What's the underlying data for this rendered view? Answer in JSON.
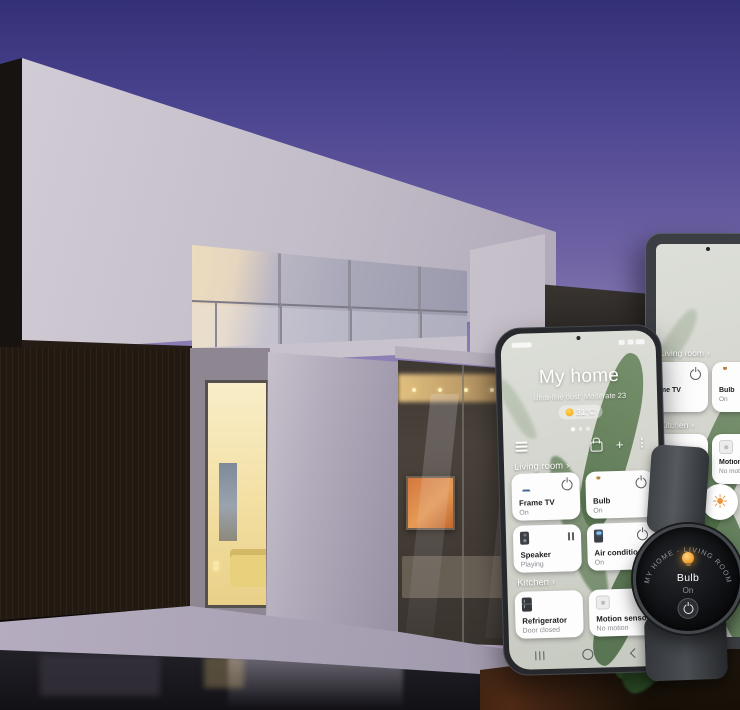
{
  "phone": {
    "app_title": "My home",
    "air_quality": "Ultra-fine dust: Moderate 23",
    "temperature": "31°C",
    "toolbar": {
      "add_glyph": "+",
      "more_glyph": "⋮"
    },
    "sections": [
      {
        "label": "Living room",
        "chevron": "›",
        "cards": [
          {
            "name": "Frame TV",
            "status": "On"
          },
          {
            "name": "Bulb",
            "status": "On"
          },
          {
            "name": "Speaker",
            "status": "Playing"
          },
          {
            "name": "Air conditioner",
            "status": "On"
          }
        ]
      },
      {
        "label": "Kitchen",
        "chevron": "›",
        "cards": [
          {
            "name": "Refrigerator",
            "status": "Door closed"
          },
          {
            "name": "Motion sensor",
            "status": "No motion"
          }
        ]
      }
    ]
  },
  "tablet": {
    "sections": [
      {
        "label": "Living room",
        "chevron": "›",
        "cards": [
          {
            "name": "Frame TV",
            "status": "On"
          },
          {
            "name": "Bulb",
            "status": "On"
          }
        ]
      },
      {
        "label": "Kitchen",
        "chevron": "›",
        "cards": [
          {
            "name": "Refrigerator",
            "status": "Door closed"
          },
          {
            "name": "Motion sensor",
            "status": "No motion"
          }
        ]
      }
    ],
    "sun_glyph": "☀"
  },
  "watch": {
    "context_arc": "MY HOME - LIVING ROOM",
    "device_name": "Bulb",
    "device_status": "On"
  },
  "colors": {
    "bulb_orange": "#f09a22",
    "tv_blue": "#79b0e4",
    "card_bg": "#fdfdfe",
    "sky_top": "#343077",
    "sky_bottom": "#c8b5cf"
  }
}
